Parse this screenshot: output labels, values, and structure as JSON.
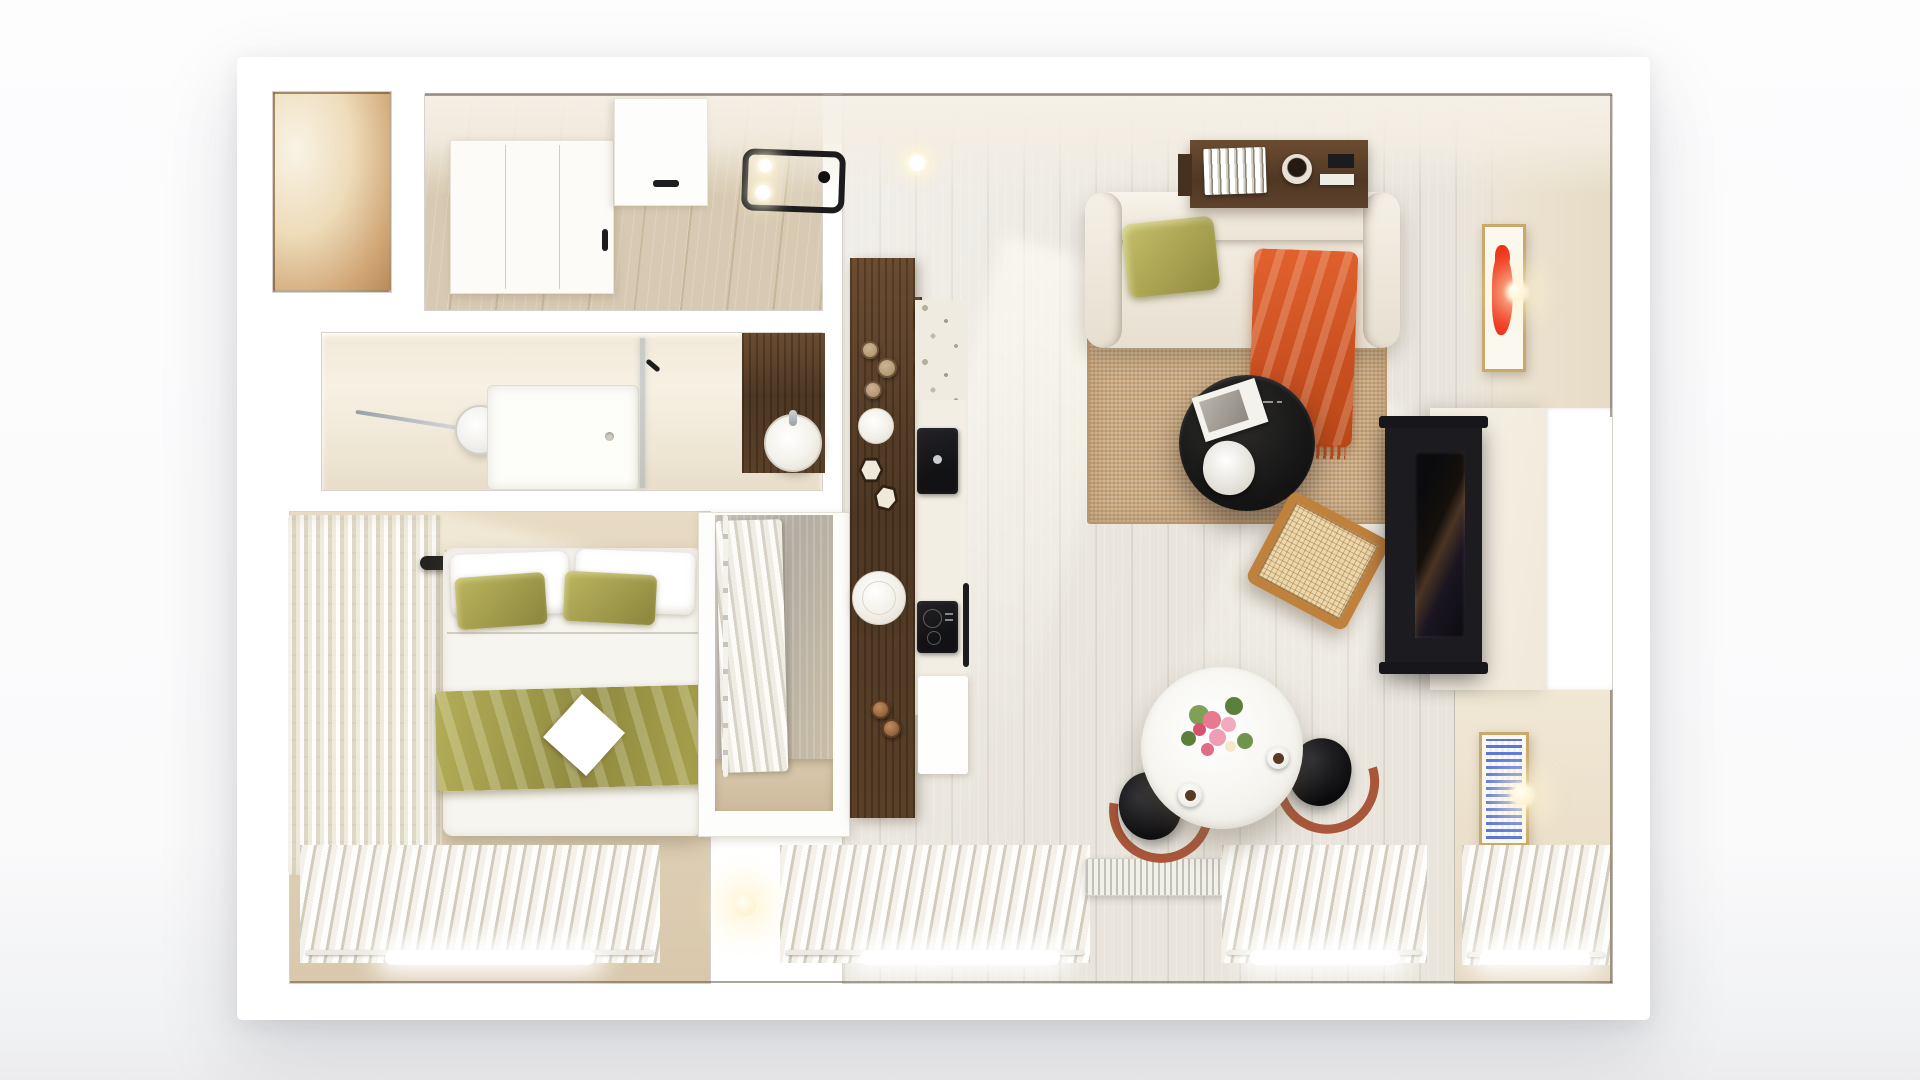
{
  "scene": {
    "type": "apartment-floor-plan-top-view-3d-render",
    "rooms": [
      "entry niche",
      "hallway",
      "bathroom",
      "bedroom",
      "closet",
      "kitchen",
      "living room",
      "dining nook"
    ]
  },
  "theme": {
    "colors": {
      "walnut": "#4e3824",
      "walnut-light": "#6b4c31",
      "oak": "#d8cab2",
      "floor": "#e9e5dd",
      "wall-warm": "#cfa372",
      "beige-floor": "#d9c8ac",
      "knit": "#f3eee0",
      "green": "#b7b15c",
      "green-dark": "#8f8a3f",
      "orange": "#c94f20",
      "rug": "#c8a77d",
      "art-red": "#ee2f14",
      "art-blue": "#3e5ed2",
      "tan-frame": "#c9a86a",
      "black": "#17171a",
      "white": "#ffffff",
      "curtain": "#f6f4ed"
    }
  },
  "rooms": {
    "entry_niche": {
      "label": "storage niche"
    },
    "hallway": {
      "items": {
        "wardrobe": "white wardrobe",
        "entry_door": "entry door",
        "ceiling_light": "black frame ceiling spotlight",
        "bulb": "ceiling bulb"
      }
    },
    "bathroom": {
      "items": {
        "shower_head": "rain shower head",
        "shower_tray": "walk-in shower tray",
        "glass": "glass partition",
        "vanity": "walnut vanity",
        "sink": "round vessel sink",
        "towel_hook": "towel hook"
      }
    },
    "bedroom": {
      "items": {
        "bed": "double bed",
        "white_pillows": "white pillows",
        "green_pillows": "olive velvet pillows",
        "green_throw": "olive velvet throw",
        "white_card": "white cushion",
        "knit_rug": "chunky knit runner",
        "reading_lamp_left": "black reading lamp",
        "reading_lamp_right": "black reading lamp",
        "headboard_rail": "headboard rail",
        "curtain": "sheer curtain",
        "window": "window light",
        "floor_lamp": "glass sphere floor lamp"
      }
    },
    "closet": {
      "items": {
        "rail": "hanging rail",
        "clothes": "hanging garments",
        "floor": "closet floor"
      }
    },
    "kitchen": {
      "items": {
        "island": "walnut island",
        "pendant_small": "pendant disc lamp",
        "pendant_large": "pendant disc lamp",
        "jars": "glass jars",
        "hex_jars": "hexagonal canisters",
        "sink": "built-in black sink",
        "cooktop": "induction cooktop",
        "counter": "terrazzo counter",
        "handle": "cabinet handle",
        "faucet_knobs": "brass faucet knobs",
        "bench": "white bench"
      }
    },
    "living_room": {
      "items": {
        "sofa": "cream sofa",
        "pillow": "olive pillow",
        "throw": "terracotta fringed throw",
        "console": "walnut wall console",
        "books": "book row",
        "bowl": "decorative bowl",
        "rug": "jute rug",
        "coffee_table": "black round coffee table",
        "magazine": "magazine",
        "sculpture": "white sculpture",
        "lounge_chair": "cane lounge chair",
        "tv": "wall-mounted tv",
        "partition": "tv partition wall",
        "art_red": "red abstract artwork",
        "sconce": "round wall sconce",
        "radiator": "panel radiator",
        "curtain": "sheer curtain"
      }
    },
    "dining_nook": {
      "items": {
        "table": "round white dining table",
        "flowers": "flower bouquet",
        "cup_left": "coffee cup",
        "cup_right": "coffee cup",
        "chair_left": "black bistro chair",
        "chair_right": "black bistro chair",
        "art_blue": "blue pattern artwork",
        "sconce": "round wall sconce",
        "curtain": "sheer curtain"
      }
    }
  }
}
